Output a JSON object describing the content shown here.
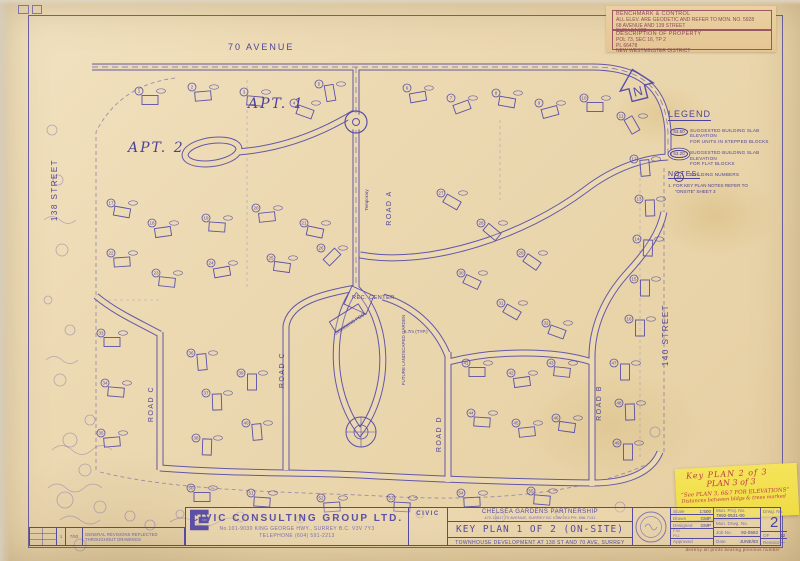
{
  "colors": {
    "paper": "#ecd9b2",
    "ink": "#554a9e",
    "note_border": "#9c5663",
    "sticky_yellow": "#f2e14e",
    "handwriting_red": "#c03a42"
  },
  "corner_note": {
    "box1_title": "BENCHMARK & CONTROL",
    "box1_lines": [
      "ALL ELEV. ARE GEODETIC AND REFER TO MON. NO. 5928",
      "68 AVENUE AND 139 STREET",
      "ELEV. 54.028"
    ],
    "box2_title": "DESCRIPTION OF PROPERTY",
    "box2_lines": [
      "POL 73, SEC 16, TP 2",
      "PL 66478",
      "NEW WESTMINSTER DISTRICT"
    ]
  },
  "north": {
    "label": "N"
  },
  "legend": {
    "title": "LEGEND",
    "items": [
      {
        "symbol": "53.50",
        "text1": "SUGGESTED BUILDING SLAB ELEVATION",
        "text2": "FOR UNITS IN STEPPED BLOCKS"
      },
      {
        "symbol": "53.20",
        "text1": "SUGGESTED BUILDING SLAB ELEVATION",
        "text2": "FOR FLAT BLOCKS"
      },
      {
        "symbol": "34",
        "text1": "BUILDING NUMBERS",
        "text2": ""
      }
    ]
  },
  "notes": {
    "title": "NOTES:",
    "items": [
      "1.  FOR KEY PLAN NOTES REFER TO",
      "“ONSITE” SHEET 3"
    ]
  },
  "plan_labels": {
    "avenue": "70 AVENUE",
    "street_left": "138 STREET",
    "street_right": "140 STREET",
    "apt1": "APT. 1",
    "apt2": "APT. 2",
    "road_a": "ROAD A",
    "road_b": "ROAD B",
    "road_c_upper": "ROAD C",
    "road_c_lower": "ROAD C",
    "road_d": "ROAD D",
    "rec_center": "REC. CENTER",
    "swimming_pool": "SWIMMING POOL",
    "future_garden": "FUTURE LANDSCAPED GARDEN",
    "temporary": "Temporary",
    "typ_note": "6.7m (TYP.)"
  },
  "yellow_note": {
    "line1": "Key PLAN 2 of 3",
    "line2": "PLAN 3 of 3",
    "line3": "“See PLAN 3, 6&7 FOR ELEVATIONS”",
    "line4": "Distances between bldgs & trees marked"
  },
  "revision_row": {
    "no": "1",
    "date": "7/93",
    "text": "GENERAL REVISIONS REFLECTED THROUGHOUT DRAWINGS"
  },
  "title_block": {
    "company": "CIVIC CONSULTING GROUP LTD.",
    "company_address": "No.101-9030 KING GEORGE HWY., SURREY B.C. V3V 7Y3",
    "company_phone": "TELEPHONE (604) 591-2213",
    "logo_text": "CIVIC",
    "client": "CHELSEA GARDENS PARTNERSHIP",
    "client_address": "#72-13817 70 AVENUE, SURREY BC  V3W 2K3  PH. 596-7131",
    "sheet_title": "KEY PLAN 1 OF 2 (ON-SITE)",
    "sheet_subtitle": "TOWNHOUSE DEVELOPMENT AT 138 ST AND 70 AVE, SURREY",
    "scale_label": "Scale",
    "scale": "1:500",
    "drawn_label": "Drawn",
    "drawn": "GMP",
    "designed_label": "Designed",
    "designed": "GMP",
    "fw_label": "F.W.",
    "pu_label": "P.U.",
    "approved_label": "Approved",
    "approved": "",
    "mun_proj_label": "Mun. Proj. No.",
    "mun_proj": "7892-0531-00",
    "mun_drwg_label": "Mun. Drwg. No.",
    "mun_drwg": "",
    "job_label": "Job No.",
    "job": "92-0592",
    "date_label": "Date",
    "date": "JUNE/93",
    "drwg_label": "Drwg. No.",
    "drwg_no": "2",
    "of_label": "OF",
    "of_value": "12",
    "revision_label": "Revision",
    "revision_value": "—"
  },
  "footnote": "destroy all prints bearing previous number",
  "building_markers": [
    [
      150,
      100,
      0,
      1
    ],
    [
      203,
      96,
      -5,
      2
    ],
    [
      255,
      101,
      5,
      3
    ],
    [
      305,
      112,
      20,
      4
    ],
    [
      330,
      93,
      80,
      5
    ],
    [
      418,
      97,
      -10,
      6
    ],
    [
      462,
      107,
      -20,
      7
    ],
    [
      507,
      102,
      10,
      8
    ],
    [
      550,
      112,
      -15,
      9
    ],
    [
      595,
      107,
      0,
      10
    ],
    [
      632,
      125,
      60,
      11
    ],
    [
      645,
      168,
      85,
      12
    ],
    [
      650,
      208,
      88,
      13
    ],
    [
      648,
      248,
      92,
      14
    ],
    [
      645,
      288,
      90,
      15
    ],
    [
      640,
      328,
      90,
      16
    ],
    [
      122,
      212,
      10,
      17
    ],
    [
      163,
      232,
      -8,
      18
    ],
    [
      217,
      227,
      4,
      19
    ],
    [
      267,
      217,
      -6,
      20
    ],
    [
      315,
      232,
      12,
      21
    ],
    [
      122,
      262,
      -4,
      22
    ],
    [
      167,
      282,
      6,
      23
    ],
    [
      222,
      272,
      -10,
      24
    ],
    [
      282,
      267,
      8,
      25
    ],
    [
      332,
      257,
      -45,
      26
    ],
    [
      452,
      202,
      30,
      27
    ],
    [
      492,
      232,
      40,
      28
    ],
    [
      532,
      262,
      35,
      29
    ],
    [
      472,
      282,
      25,
      30
    ],
    [
      512,
      312,
      30,
      31
    ],
    [
      557,
      332,
      20,
      32
    ],
    [
      112,
      342,
      0,
      33
    ],
    [
      116,
      392,
      5,
      34
    ],
    [
      112,
      442,
      -5,
      35
    ],
    [
      202,
      362,
      85,
      36
    ],
    [
      217,
      402,
      88,
      37
    ],
    [
      207,
      447,
      92,
      38
    ],
    [
      252,
      382,
      90,
      39
    ],
    [
      257,
      432,
      85,
      40
    ],
    [
      477,
      372,
      0,
      41
    ],
    [
      522,
      382,
      -8,
      42
    ],
    [
      562,
      372,
      6,
      43
    ],
    [
      482,
      422,
      4,
      44
    ],
    [
      527,
      432,
      -6,
      45
    ],
    [
      567,
      427,
      8,
      46
    ],
    [
      625,
      372,
      90,
      47
    ],
    [
      630,
      412,
      88,
      48
    ],
    [
      628,
      452,
      90,
      49
    ],
    [
      202,
      497,
      0,
      50
    ],
    [
      262,
      502,
      4,
      51
    ],
    [
      332,
      507,
      -4,
      52
    ],
    [
      402,
      507,
      3,
      53
    ],
    [
      472,
      502,
      -3,
      54
    ],
    [
      542,
      500,
      5,
      55
    ]
  ],
  "vegetation": [
    [
      70,
      440,
      7
    ],
    [
      85,
      470,
      6
    ],
    [
      65,
      500,
      8
    ],
    [
      100,
      507,
      6
    ],
    [
      130,
      516,
      5
    ],
    [
      90,
      420,
      5
    ],
    [
      60,
      380,
      6
    ],
    [
      70,
      330,
      5
    ],
    [
      62,
      250,
      6
    ],
    [
      58,
      180,
      5
    ],
    [
      52,
      130,
      5
    ],
    [
      180,
      514,
      4
    ],
    [
      240,
      517,
      5
    ],
    [
      300,
      519,
      4
    ],
    [
      420,
      514,
      4
    ],
    [
      500,
      517,
      5
    ],
    [
      560,
      514,
      4
    ],
    [
      620,
      507,
      5
    ],
    [
      655,
      432,
      5
    ],
    [
      48,
      300,
      4
    ],
    [
      80,
      545,
      6
    ],
    [
      150,
      525,
      5
    ]
  ]
}
